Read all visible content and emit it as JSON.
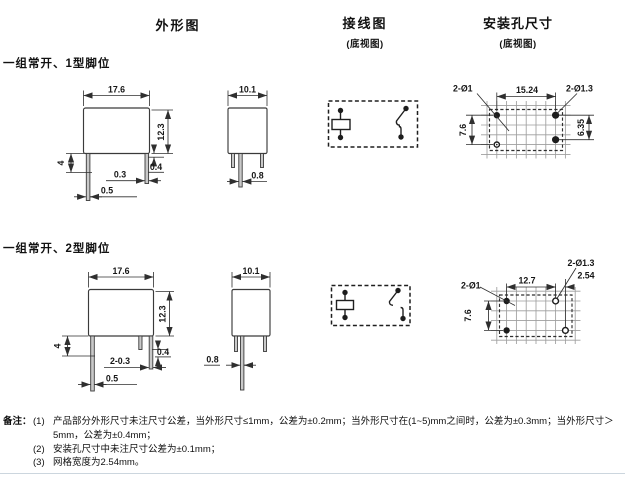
{
  "columns": {
    "outline": {
      "title": "外形图"
    },
    "wiring": {
      "title": "接线图",
      "subtitle": "(底视图)"
    },
    "mounting": {
      "title": "安装孔尺寸",
      "subtitle": "(底视图)"
    }
  },
  "sections": {
    "type1": {
      "label": "一组常开、1型脚位",
      "front": {
        "width": "17.6",
        "height": "12.3",
        "pin_length": "4",
        "pin_thickness": "0.3",
        "standoff": "0.4",
        "pin_width": "0.5"
      },
      "side": {
        "width": "10.1",
        "pin_width": "0.8"
      },
      "mount": {
        "holes_small": "2-Ø1",
        "pitch_x": "15.24",
        "holes_large": "2-Ø1.3",
        "pitch_left": "7.6",
        "pitch_right": "6.35"
      }
    },
    "type2": {
      "label": "一组常开、2型脚位",
      "front": {
        "width": "17.6",
        "height": "12.3",
        "pin_length": "4",
        "pin_thickness": "2-0.3",
        "standoff": "0.4",
        "pin_width": "0.5"
      },
      "side": {
        "width": "10.1",
        "pin_width": "0.8"
      },
      "mount": {
        "holes_small": "2-Ø1",
        "pitch_x": "12.7",
        "holes_large": "2-Ø1.3",
        "offset": "2.54",
        "pitch_left": "7.6"
      }
    }
  },
  "notes": {
    "label": "备注：",
    "items": [
      {
        "no": "(1)",
        "text": "产品部分外形尺寸未注尺寸公差，当外形尺寸≤1mm，公差为±0.2mm；当外形尺寸在(1~5)mm之间时，公差为±0.3mm；当外形尺寸＞5mm，公差为±0.4mm；"
      },
      {
        "no": "(2)",
        "text": "安装孔尺寸中未注尺寸公差为±0.1mm；"
      },
      {
        "no": "(3)",
        "text": "网格宽度为2.54mm。"
      }
    ]
  }
}
